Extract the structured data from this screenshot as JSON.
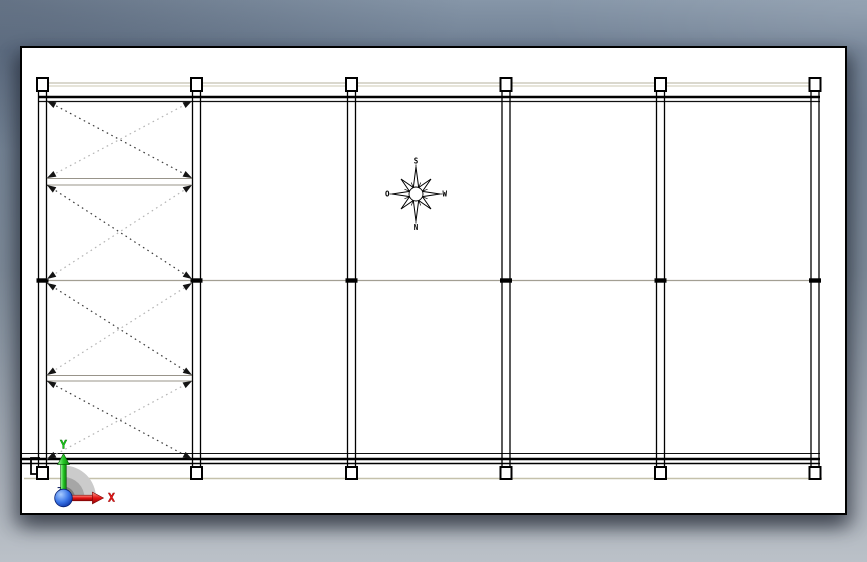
{
  "window": {
    "width": 867,
    "height": 562
  },
  "viewport": {
    "background_top": "#8696a8",
    "background_mid": "#7d8a98",
    "background_bottom": "#bbc1c8"
  },
  "sheet": {
    "x": 20,
    "y": 46,
    "width": 827,
    "height": 469,
    "fill": "#ffffff",
    "border_color": "#000000"
  },
  "structure": {
    "columns": {
      "centers_x": [
        42.5,
        196.5,
        351.5,
        506,
        660.5,
        815
      ],
      "shaft_half_gap": 4,
      "shaft_top": 90,
      "shaft_bottom": 468,
      "shaft_color": "#000000",
      "shaft_width": 1.3,
      "cap": {
        "y": 78,
        "w": 11,
        "h": 13
      },
      "foot": {
        "y": 467,
        "w": 11,
        "h": 12
      },
      "plate_fill": "#ffffff",
      "plate_stroke": "#000000",
      "plate_stroke_width": 2
    },
    "beams": [
      {
        "name": "top-edge-line-1",
        "y": 83,
        "x1": 40,
        "x2": 818,
        "w": 1,
        "color": "#b6b29c"
      },
      {
        "name": "top-edge-line-2",
        "y": 86,
        "x1": 40,
        "x2": 818,
        "w": 1,
        "color": "#cdc9b3"
      },
      {
        "name": "top-beam-heavy",
        "y": 97,
        "x1": 38,
        "x2": 820,
        "w": 2.6,
        "color": "#000000"
      },
      {
        "name": "top-beam-light",
        "y": 101.5,
        "x1": 38,
        "x2": 820,
        "w": 1.3,
        "color": "#111111"
      },
      {
        "name": "mid-beam",
        "y": 280.5,
        "x1": 38,
        "x2": 820,
        "w": 1.2,
        "color": "#a39f93"
      },
      {
        "name": "bottom-beam-light",
        "y": 453.5,
        "x1": 22,
        "x2": 820,
        "w": 1.1,
        "color": "#111111"
      },
      {
        "name": "bottom-beam-heavy",
        "y": 459,
        "x1": 22,
        "x2": 820,
        "w": 2.6,
        "color": "#000000"
      },
      {
        "name": "bottom-beam-mid",
        "y": 463.5,
        "x1": 22,
        "x2": 820,
        "w": 1.6,
        "color": "#000000"
      },
      {
        "name": "bottom-edge-line",
        "y": 478.5,
        "x1": 24,
        "x2": 822,
        "w": 1.6,
        "color": "#c5c1ab"
      }
    ],
    "bay_lines": [
      {
        "y": 178.5,
        "x1": 46,
        "x2": 193
      },
      {
        "y": 185,
        "x1": 46,
        "x2": 193
      },
      {
        "y": 375.5,
        "x1": 46,
        "x2": 193
      },
      {
        "y": 381,
        "x1": 46,
        "x2": 193
      }
    ],
    "bay_line_color": "#98948a",
    "mid_marks": {
      "y": 280.5,
      "w": 12,
      "h": 4.4,
      "color": "#000000"
    },
    "braces": {
      "x1": 47,
      "x2": 192,
      "panels": [
        [
          101,
          178
        ],
        [
          185,
          279
        ],
        [
          283,
          375
        ],
        [
          381,
          459
        ]
      ],
      "dark": "#3c3c3c",
      "light": "#b4b4b4",
      "width": 1.2,
      "dash": "1.6 3.6",
      "arrow_color": "#141414",
      "arrow_len": 9,
      "arrow_half_w": 3.2
    },
    "end_bracket": {
      "x": 31,
      "y1": 458,
      "y2": 474,
      "arm": 9,
      "color": "#000000"
    }
  },
  "compass": {
    "icon": "compass-rose-icon",
    "center_x": 416,
    "center_y": 194,
    "labels": {
      "top": "S",
      "bottom": "N",
      "left": "O",
      "right": "W"
    }
  },
  "triad": {
    "icon": "origin-triad-icon",
    "labels": {
      "x_axis": "X",
      "y_axis": "Y",
      "z_axis": "Z"
    },
    "colors": {
      "x_axis": "#e81515",
      "y_axis": "#18cb18",
      "z_axis": "#1b2a6b",
      "origin_sphere": "#1d4fd6",
      "wedge_outer": "#cbcbcb",
      "wedge_mid": "#a6a6a6",
      "wedge_core": "#7b7b7b"
    }
  }
}
